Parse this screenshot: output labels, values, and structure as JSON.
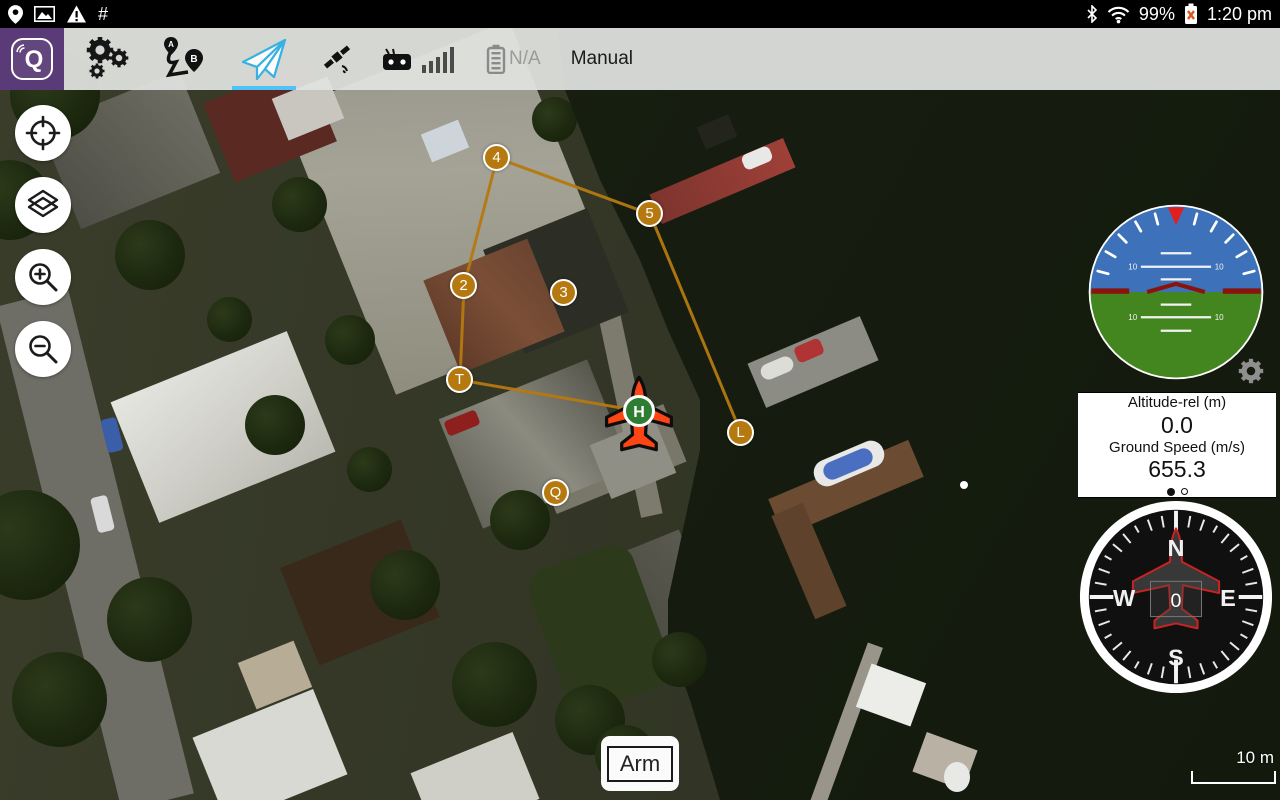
{
  "status_bar": {
    "hash": "#",
    "battery_percent": "99%",
    "time": "1:20 pm",
    "left_icons": [
      "location-icon",
      "image-icon",
      "warning-icon",
      "hash-symbol"
    ],
    "right_icons": [
      "bluetooth-icon",
      "wifi-icon",
      "battery-unknown-icon"
    ]
  },
  "toolbar": {
    "logo_letter": "Q",
    "plan_a": "A",
    "plan_b": "B",
    "battery_status": "N/A",
    "mode_label": "Manual",
    "icons": [
      "qgc-logo",
      "vehicle-setup-gears-icon",
      "plan-route-icon",
      "fly-paper-plane-icon",
      "gps-satellite-icon",
      "rc-transmitter-icon",
      "rc-signal-bars",
      "battery-icon"
    ],
    "selected_view": "fly",
    "accent_color": "#4fc3f7"
  },
  "map": {
    "type": "satellite",
    "scale_label": "10 m",
    "arm_label": "Arm",
    "home_label": "H",
    "waypoints": [
      {
        "label": "2"
      },
      {
        "label": "3"
      },
      {
        "label": "4"
      },
      {
        "label": "5"
      },
      {
        "label": "T"
      },
      {
        "label": "L"
      },
      {
        "label": "Q"
      }
    ],
    "path_color": "#b5790f",
    "vehicle_color": "#ff4514",
    "home_color": "#2e7d32"
  },
  "instruments": {
    "altitude_label": "Altitude-rel (m)",
    "altitude_value": "0.0",
    "speed_label": "Ground Speed (m/s)",
    "speed_value": "655.3",
    "pitch_label": "10",
    "attitude_sky_color": "#3d72ba",
    "attitude_ground_color": "#43861f",
    "compass": {
      "n": "N",
      "e": "E",
      "s": "S",
      "w": "W",
      "heading": "0"
    }
  },
  "colors": {
    "logo_purple": "#5b3b77",
    "toolbar_bg": "#e1e3e0",
    "water": "#161d10"
  }
}
